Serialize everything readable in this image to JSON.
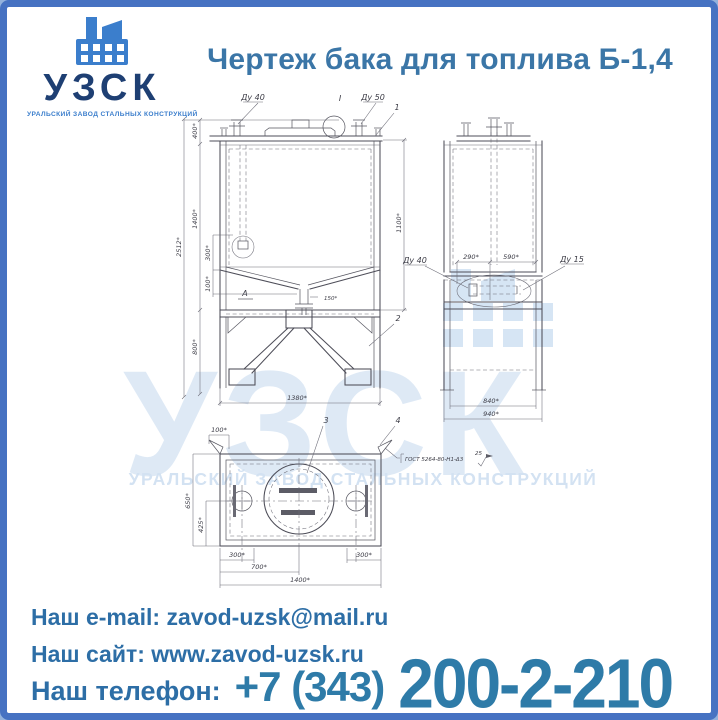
{
  "page": {
    "frame_color": "#4672c2",
    "accent_blue": "#3b7ecc",
    "text_blue": "#2d6ea6"
  },
  "header": {
    "logo": {
      "name": "УЗСК",
      "tagline": "УРАЛЬСКИЙ ЗАВОД СТАЛЬНЫХ КОНСТРУКЦИЙ"
    },
    "title": "Чертеж бака для топлива Б-1,4"
  },
  "drawing": {
    "watermark": {
      "name": "УЗСК",
      "tagline": "УРАЛЬСКИЙ ЗАВОД СТАЛЬНЫХ КОНСТРУКЦИЙ"
    },
    "callouts": {
      "dy40_top": "Ду 40",
      "dy50_top": "Ду 50",
      "section_mark": "I",
      "item1": "1",
      "item2": "2",
      "item3": "3",
      "item4": "4",
      "view_a": "А",
      "dy40_side": "Ду 40",
      "dy15_side": "Ду 15",
      "gost_note": "ГОСТ 5264-80-Н1-Δ3",
      "gost_size": "25"
    },
    "dims": {
      "front_total_h": "2512*",
      "front_top": "400*",
      "front_tank_h": "1400*",
      "front_cone1": "300*",
      "front_cone2": "100*",
      "front_support_h": "800*",
      "front_right_h": "1100*",
      "front_width": "1380*",
      "front_drain": "150*",
      "side_a": "290*",
      "side_b": "590*",
      "side_w1": "840*",
      "side_w2": "940*",
      "plan_lug": "100*",
      "plan_h1": "650*",
      "plan_h2": "425*",
      "plan_b_left": "300*",
      "plan_b_mid": "700*",
      "plan_b_full": "1400*",
      "plan_b_right": "300*"
    }
  },
  "footer": {
    "email_label": "Наш e-mail:",
    "email": "zavod-uzsk@mail.ru",
    "site_label": "Наш сайт:",
    "site": "www.zavod-uzsk.ru",
    "phone_label": "Наш телефон:",
    "phone_code": "+7 (343)",
    "phone_number": "200-2-210"
  }
}
